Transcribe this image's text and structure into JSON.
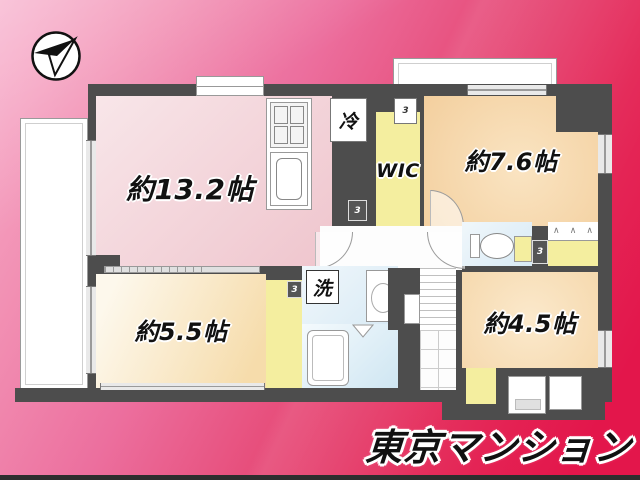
{
  "branding": {
    "logo_text": "東京マンション"
  },
  "compass": {
    "icon": "north-compass"
  },
  "floor_plan": {
    "door_marker": "3",
    "hanger_glyph": "∧",
    "rooms": {
      "ldk": {
        "label": "約13.2帖"
      },
      "bedroom_76": {
        "label": "約7.6帖"
      },
      "bedroom_55": {
        "label": "約5.5帖"
      },
      "bedroom_45": {
        "label": "約4.5帖"
      },
      "wic": {
        "label": "WIC"
      },
      "refrigerator": {
        "label": "冷"
      },
      "laundry": {
        "label": "洗"
      }
    },
    "colors": {
      "wall": "#4d4d4d",
      "closet_yellow": "#f4ee9f",
      "wet_area_blue": "#d8eaf5",
      "ldk_pink": "#efc6ce",
      "bedroom_peach": "#f5d2a4",
      "bedroom_cream": "#f6dcab",
      "background_pink": "#f5a3c4",
      "background_red": "#e3164b"
    }
  }
}
